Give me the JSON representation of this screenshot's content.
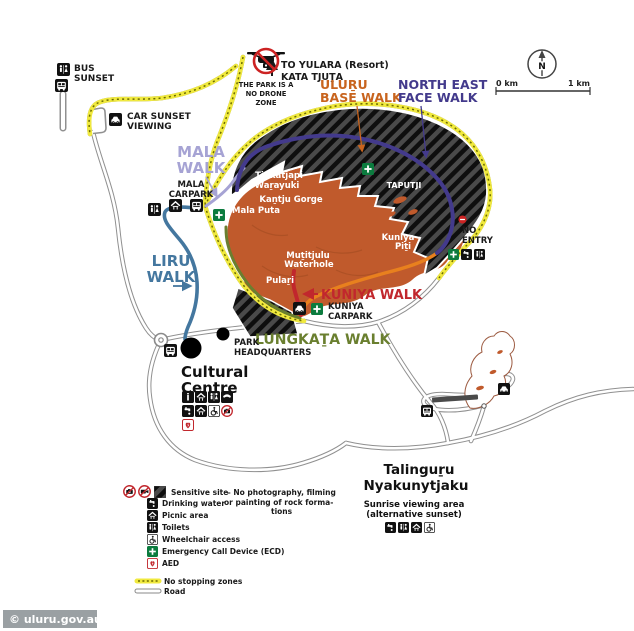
{
  "top": {
    "bus_sunset": [
      "BUS",
      "SUNSET"
    ],
    "car_sunset": [
      "CAR SUNSET",
      "VIEWING"
    ],
    "to_yulara": [
      "TO YULARA (Resort)",
      "KATA TJUṮA"
    ],
    "drone_notice": [
      "THE PARK IS A",
      "NO DRONE",
      "ZONE"
    ],
    "scale": {
      "left": "0 km",
      "right": "1 km",
      "north": "N"
    }
  },
  "walk_labels": {
    "uluru_base": [
      "ULUṞU",
      "BASE WALK"
    ],
    "north_east_face": [
      "NORTH EAST",
      "FACE WALK"
    ],
    "mala": [
      "MALA",
      "WALK"
    ],
    "liru": [
      "LIRU",
      "WALK"
    ],
    "kuniya": "KUNIYA WALK",
    "lungkata": "LUNGKAṮA WALK"
  },
  "features": {
    "tjukatjapi": [
      "Tjukatjapi",
      "Waṟayuki"
    ],
    "kantju": "Kaṉtju Gorge",
    "mala_puta": "Mala Puta",
    "taputji": "TAPUTJI",
    "kuniya_piti": [
      "Kuniya",
      "Piṯi"
    ],
    "mutitjulu": [
      "Muṯitjulu",
      "Waterhole"
    ],
    "pulari": "Pulaṟi",
    "no_entry": [
      "NO",
      "ENTRY"
    ]
  },
  "places": {
    "mala_carpark": [
      "MALA",
      "CARPARK"
    ],
    "kuniya_carpark": [
      "KUNIYA",
      "CARPARK"
    ],
    "park_headquarters": [
      "PARK",
      "HEADQUARTERS"
    ],
    "cultural_centre": [
      "Cultural",
      "Centre"
    ],
    "talinguru": {
      "name": [
        "Talinguṟu",
        "Nyakunytjaku"
      ],
      "desc": [
        "Sunrise viewing area",
        "(alternative sunset)"
      ]
    }
  },
  "legend": {
    "sensitive_title": "Sensitive site",
    "sensitive_line1": "– No photography, filming",
    "sensitive_line2": "or painting of rock forma-",
    "sensitive_line3": "tions",
    "items": [
      "Drinking water",
      "Picnic area",
      "Toilets",
      "Wheelchair access",
      "Emergency Call Device (ECD)",
      "AED"
    ],
    "no_stopping": "No stopping zones",
    "road": "Road"
  },
  "watermark": "© uluru.gov.au",
  "colors": {
    "rock": "#c05a2c",
    "base_walk": "#e8801e",
    "base_walk_label": "#c8641e",
    "north_east_face_walk": "#433a8c",
    "mala_walk": "#a6a3d4",
    "liru_walk": "#44779f",
    "kuniya_walk": "#c1272d",
    "lungkata_walk": "#6a7f2f",
    "no_stopping_yellow": "#f0e93e",
    "ecd_green": "#0b7b3e",
    "prohibition_red": "#cc2222"
  },
  "icon_glyphs": {
    "toilets-icon": "two figures",
    "bus-icon": "bus front",
    "car-icon": "car front",
    "drinking-water-icon": "tap",
    "picnic-icon": "shelter over table",
    "info-icon": "i",
    "phone-icon": "handset",
    "wheelchair-icon": "wheelchair",
    "ecd-icon": "white cross on green",
    "aed-icon": "red heart",
    "no-photography-icon": "crossed camera",
    "no-filming-icon": "crossed video camera",
    "no-entry-icon": "red disc with white bar",
    "no-drone-icon": "drone in red prohibition circle",
    "north-arrow-icon": "N arrow in circle"
  }
}
